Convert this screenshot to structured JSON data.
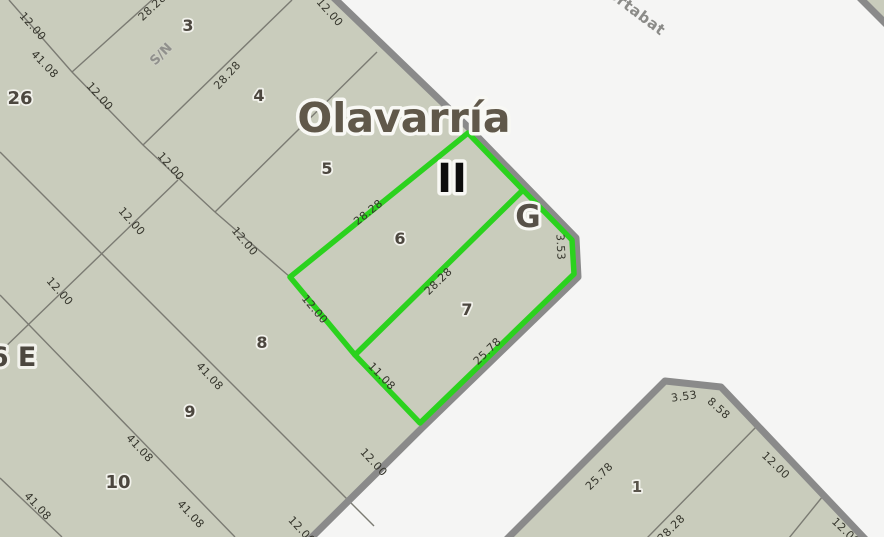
{
  "map": {
    "title_label": "Olavarría",
    "roman_marker": "II",
    "g_marker": "G",
    "edge_label": "6 E",
    "street_label": "ortabat",
    "no_number_label": "S/N",
    "colors": {
      "parcel_fill": "#c9ccbc",
      "road_background": "#f5f5f4",
      "parcel_line": "#7b7b73",
      "block_border": "#8a8a8a",
      "selection_green": "#2bd21e",
      "dimension_text": "#35352c",
      "parcel_number_text": "#4c473f",
      "title_text": "#60584a"
    },
    "parcel_numbers": [
      "26",
      "3",
      "4",
      "5",
      "6",
      "7",
      "8",
      "9",
      "10",
      "1"
    ],
    "dims": [
      "12.00",
      "41.08",
      "28.28",
      "12.00",
      "28.28",
      "12.00",
      "12.00",
      "12.00",
      "12.00",
      "12.00",
      "28.28",
      "12.00",
      "28.28",
      "3.53",
      "11.08",
      "25.78",
      "41.08",
      "12.00",
      "41.08",
      "41.08",
      "12.00",
      "41.08",
      "3.53",
      "8.58",
      "25.78",
      "12.00",
      "28.28",
      "12.00"
    ]
  }
}
